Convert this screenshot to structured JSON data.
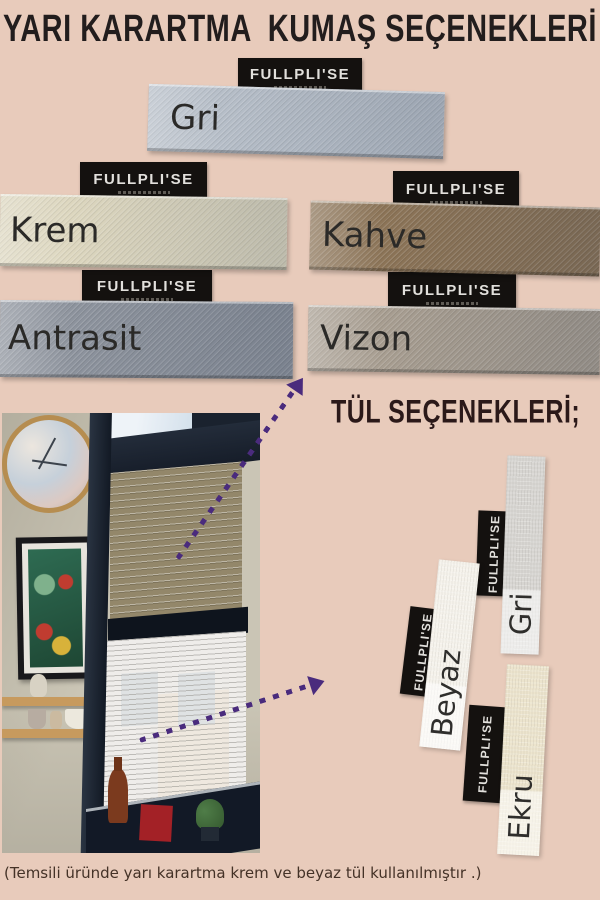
{
  "poster": {
    "background_color": "#e8cbbb",
    "title": "Yarı Karartma  Kumaş Seçenekleri",
    "brand_label": "FULLPLI'SE",
    "fabric_section": {
      "options": [
        {
          "name": "Gri",
          "color": "#b6bec8"
        },
        {
          "name": "Krem",
          "color": "#ddd7bf"
        },
        {
          "name": "Kahve",
          "color": "#8c7457"
        },
        {
          "name": "Antrasit",
          "color": "#8d939d"
        },
        {
          "name": "Vizon",
          "color": "#a89e91"
        }
      ]
    },
    "tulle_section": {
      "heading": "Tül Seçenekleri;",
      "options": [
        {
          "name": "Gri",
          "color": "#d7d5d1"
        },
        {
          "name": "Beyaz",
          "color": "#f5f2eb"
        },
        {
          "name": "Ekru",
          "color": "#ece4cd"
        }
      ]
    },
    "footnote": "(Temsili üründe yarı karartma krem ve beyaz tül kullanılmıştır .)",
    "arrow_color": "#4a2b7d"
  }
}
